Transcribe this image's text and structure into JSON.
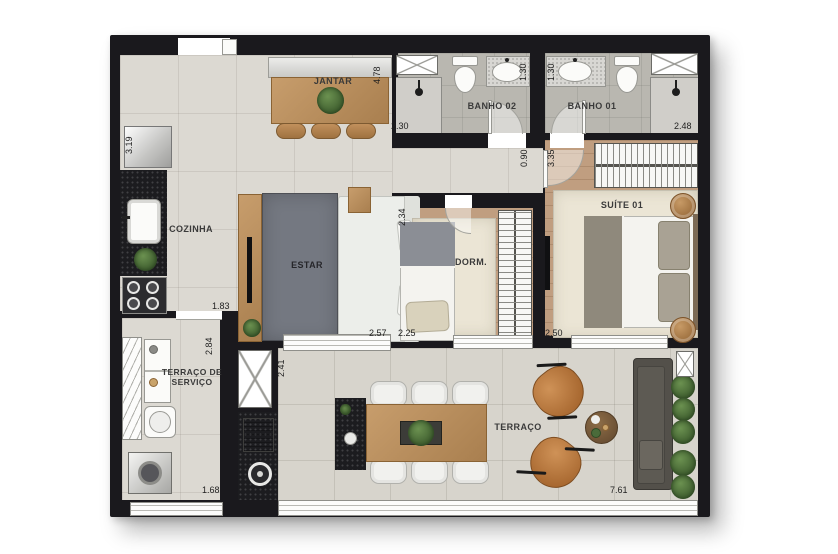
{
  "floorplan": {
    "rooms": {
      "jantar": "JANTAR",
      "banho02": "BANHO 02",
      "banho01": "BANHO 01",
      "cozinha": "COZINHA",
      "estar": "ESTAR",
      "dorm": "DORM.",
      "suite": "SUÍTE 01",
      "servico_line1": "TERRAÇO DE",
      "servico_line2": "SERVIÇO",
      "terraco": "TERRAÇO"
    },
    "dims": {
      "jantar_depth": "4.78",
      "fridge_niche": "3.19",
      "banho02_width": "2.30",
      "banho02_side": "1.30",
      "banho01_side": "1.30",
      "banho01_width": "2.48",
      "hall_width": "0.90",
      "suite_depth": "3.35",
      "cozinha_width": "1.83",
      "servico_depth": "2.84",
      "estar_width": "2.57",
      "dorm_width": "2.25",
      "dorm_depth": "2.34",
      "suite_width": "2.50",
      "terraco_depth": "2.41",
      "servico_width": "1.68",
      "terraco_width": "7.61"
    },
    "colors": {
      "wall": "#1a191d",
      "floor_tile": "#dcd9d2",
      "bath_tile": "#b9b7b0",
      "wood_floor": "#c09e80",
      "furniture_wood": "#b9905f",
      "rug_dark": "#747881",
      "rug_light": "#ebe5d5",
      "granite": "#1c1c1f",
      "leather_chair": "#b4743f",
      "plant_green": "#4a6b3a",
      "outdoor_sofa": "#53504a"
    }
  }
}
